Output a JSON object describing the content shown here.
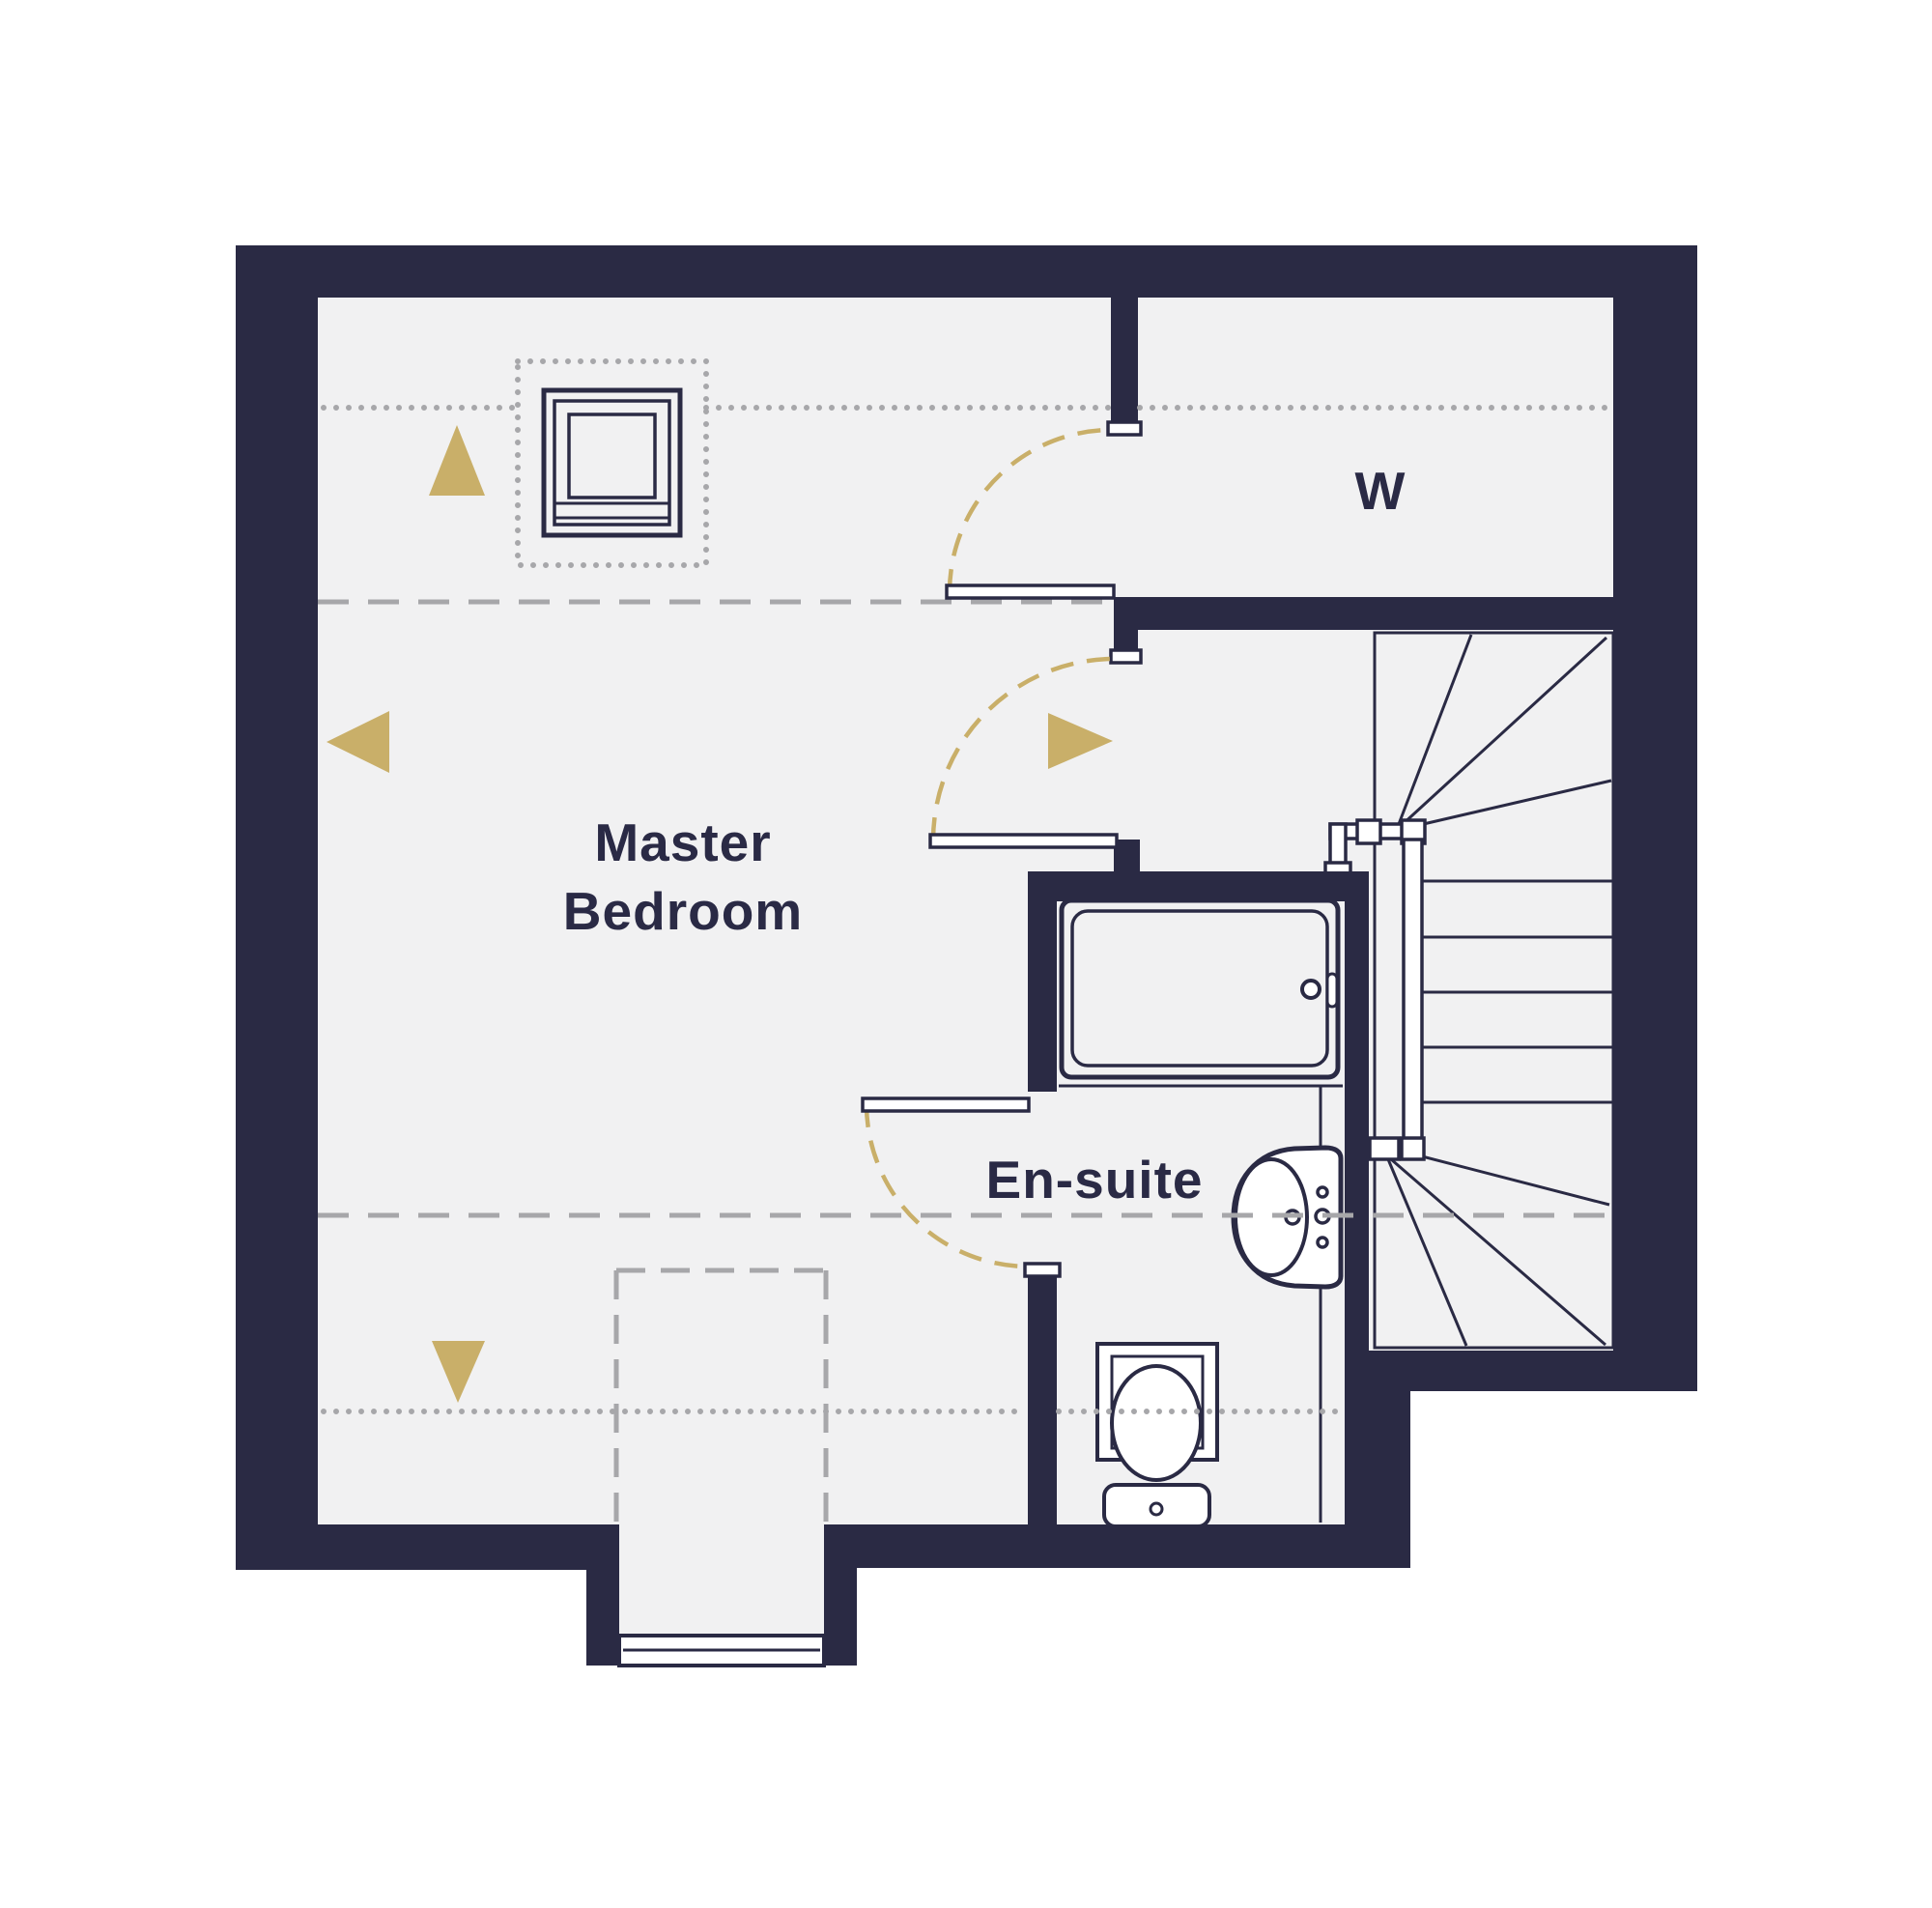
{
  "plan": {
    "type": "floor-plan",
    "rooms": [
      {
        "id": "master-bedroom",
        "label_lines": [
          "Master",
          "Bedroom"
        ]
      },
      {
        "id": "ensuite",
        "label": "En-suite"
      },
      {
        "id": "wardrobe",
        "label": "W"
      }
    ],
    "labels": {
      "master_line1": "Master",
      "master_line2": "Bedroom",
      "ensuite": "En-suite",
      "wardrobe": "W"
    },
    "icons": [
      "skylight-window-icon",
      "bath-icon",
      "sink-icon",
      "toilet-icon",
      "staircase-icon",
      "dormer-window-icon",
      "door-swing-icon",
      "direction-arrow-up-icon",
      "direction-arrow-left-icon",
      "direction-arrow-right-icon",
      "direction-arrow-down-icon"
    ],
    "guides": {
      "dotted_lines": "eaves / reduced head-height markers",
      "dashed_lines": "ceiling height change markers",
      "dashed_rectangle": "dormer recess outline"
    }
  },
  "colors": {
    "wall": "#2a2a44",
    "text": "#2a2a45",
    "floor": "#f1f1f2",
    "gold": "#c9af69",
    "guide": "#a7a7aa",
    "background": "#ffffff"
  }
}
